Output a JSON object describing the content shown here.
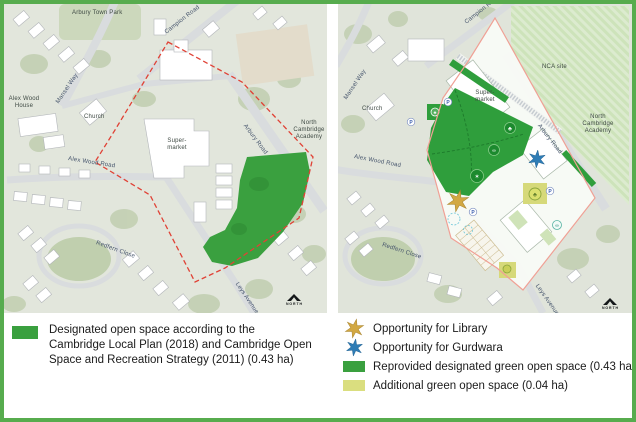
{
  "figure": {
    "type": "two-panel planning map, existing site (left) and masterplan proposal (right)",
    "border_color": "#57ac4e"
  },
  "colors": {
    "designated_green": "#3aa03f",
    "additional_green": "#dade7f",
    "library_star": "#d2a843",
    "gurdwara_star": "#2e7cb5",
    "boundary_red_dashed": "#e04236",
    "boundary_pink": "#f0a095",
    "map_background": "#e2e6dc"
  },
  "left_map": {
    "labels": {
      "arbury_town_park": "Arbury Town Park",
      "campion_road": "Campion Road",
      "mansel_way": "Mansel Way",
      "alex_wood_house": "Alex Wood House",
      "church": "Church",
      "supermarket": "Super-market",
      "arbury_road": "Arbury Road",
      "north_cambridge_academy": "North Cambridge Academy",
      "alex_wood_road": "Alex Wood Road",
      "redfern_close": "Redfern Close",
      "leys_avenue": "Leys Avenue",
      "north": "NORTH"
    }
  },
  "right_map": {
    "labels": {
      "campion_road": "Campion Rd",
      "mansel_way": "Mansel Way",
      "church": "Church",
      "nca_site": "NCA site",
      "supermarket": "Super-market",
      "arbury_road": "Arbury Road",
      "north_cambridge_academy": "North Cambridge Academy",
      "alex_wood_road": "Alex Wood Road",
      "redfern_close": "Redfern Close",
      "leys_avenue": "Leys Avenue",
      "north": "NORTH"
    },
    "icons": {
      "parking": "P",
      "tree": "♣",
      "play": "✶",
      "cycle": "∞"
    }
  },
  "legend_left": {
    "swatch_color": "#3aa03f",
    "lines": [
      "Designated open space according to the",
      "Cambridge Local Plan (2018) and Cambridge Open",
      "Space and Recreation Strategy (2011)  (0.43 ha)"
    ]
  },
  "legend_right": {
    "items": [
      {
        "icon": "star",
        "color": "#d2a843",
        "label": "Opportunity for Library"
      },
      {
        "icon": "star",
        "color": "#2e7cb5",
        "label": "Opportunity for Gurdwara"
      },
      {
        "icon": "swatch",
        "color": "#3aa03f",
        "label": "Reprovided designated green open space (0.43 ha)"
      },
      {
        "icon": "swatch",
        "color": "#dade7f",
        "label": "Additional green open space (0.04 ha)"
      }
    ]
  }
}
